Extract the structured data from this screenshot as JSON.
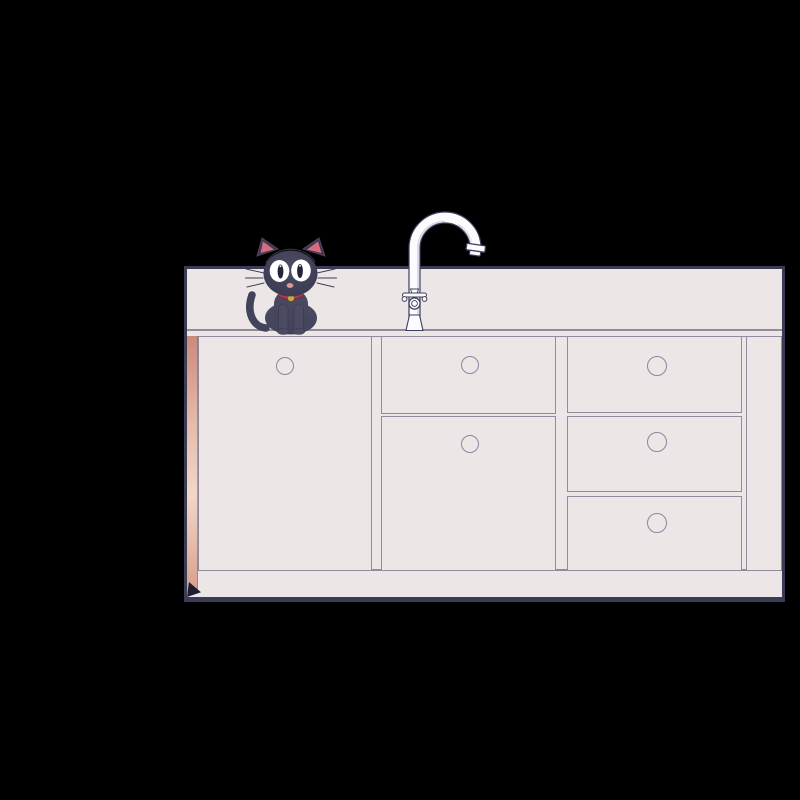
{
  "scene": {
    "background_color": "#000000",
    "subject": "Cartoon black cat sitting on a kitchen counter beside a gooseneck faucet, above a cabinet with one door and five drawers"
  },
  "colors": {
    "background": "#000000",
    "cabinet_fill": "#ece6e7",
    "cabinet_outline": "#3b3b56",
    "panel_line": "#928ba0",
    "knob_line": "#8d86a0",
    "side_strip_top": "#cb8a7c",
    "side_strip_mid": "#f2d7c8",
    "side_strip_bottom": "#d89e8b",
    "corner_shadow": "#1d1d30",
    "cat_body": "#42425a",
    "cat_body_light": "#4b4b63",
    "cat_head_dark": "#393952",
    "cat_ear_inner": "#d66c7e",
    "cat_eye_white": "#ffffff",
    "cat_pupil": "#23233c",
    "cat_nose": "#d9998e",
    "cat_collar": "#b23a44",
    "cat_bell": "#e7c04b",
    "faucet_fill": "#fcfbfd",
    "faucet_outline": "#3e3e5c",
    "faucet_shade": "#d2d2e0"
  },
  "cabinet": {
    "knob_count": 6,
    "sections": [
      {
        "name": "left-door",
        "type": "door",
        "knobs": 1
      },
      {
        "name": "middle-stack",
        "type": "drawers",
        "drawers": 2
      },
      {
        "name": "right-stack",
        "type": "drawers",
        "drawers": 3
      },
      {
        "name": "right-filler",
        "type": "panel",
        "drawers": 0
      }
    ]
  },
  "cat": {
    "color": "black",
    "pose": "sitting-front",
    "accessory": "red collar with gold bell"
  },
  "faucet": {
    "style": "gooseneck",
    "parts": [
      "spout",
      "aerator",
      "handle",
      "base"
    ]
  }
}
